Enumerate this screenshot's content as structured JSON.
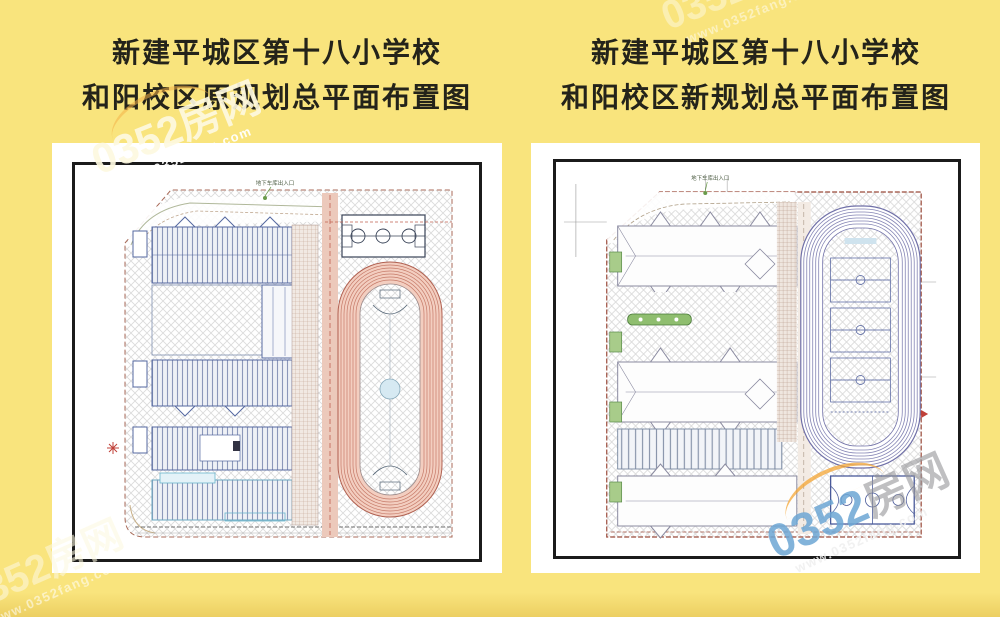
{
  "page": {
    "background_color": "#f9e47d",
    "watermark": {
      "brand": "0352房网",
      "brand_prefix": "0352",
      "brand_suffix": "房网",
      "url": "www.0352fang.com",
      "accent_orange": "#f4a634",
      "accent_blue": "#6ca6d4"
    }
  },
  "left_section": {
    "title_line1": "新建平城区第十八小学校",
    "title_line2": "和阳校区原规划总平面布置图",
    "plan": {
      "name": "original-master-plan",
      "top_annotation": "地下车库出入口"
    }
  },
  "right_section": {
    "title_line1": "新建平城区第十八小学校",
    "title_line2": "和阳校区新规划总平面布置图",
    "plan": {
      "name": "new-master-plan",
      "top_annotation": "地下车库出入口"
    }
  },
  "colors": {
    "panel": "#ffffff",
    "frame": "#1b1b1b",
    "left_track_lane": "#f3cec0",
    "left_track_line": "#c67a68",
    "right_track_line": "#7070a8",
    "site_boundary": "#9a4a3a",
    "building_outline_left": "#5568a0",
    "building_outline_right": "#8a8aa0",
    "landscape_green": "#8fbe6f"
  }
}
